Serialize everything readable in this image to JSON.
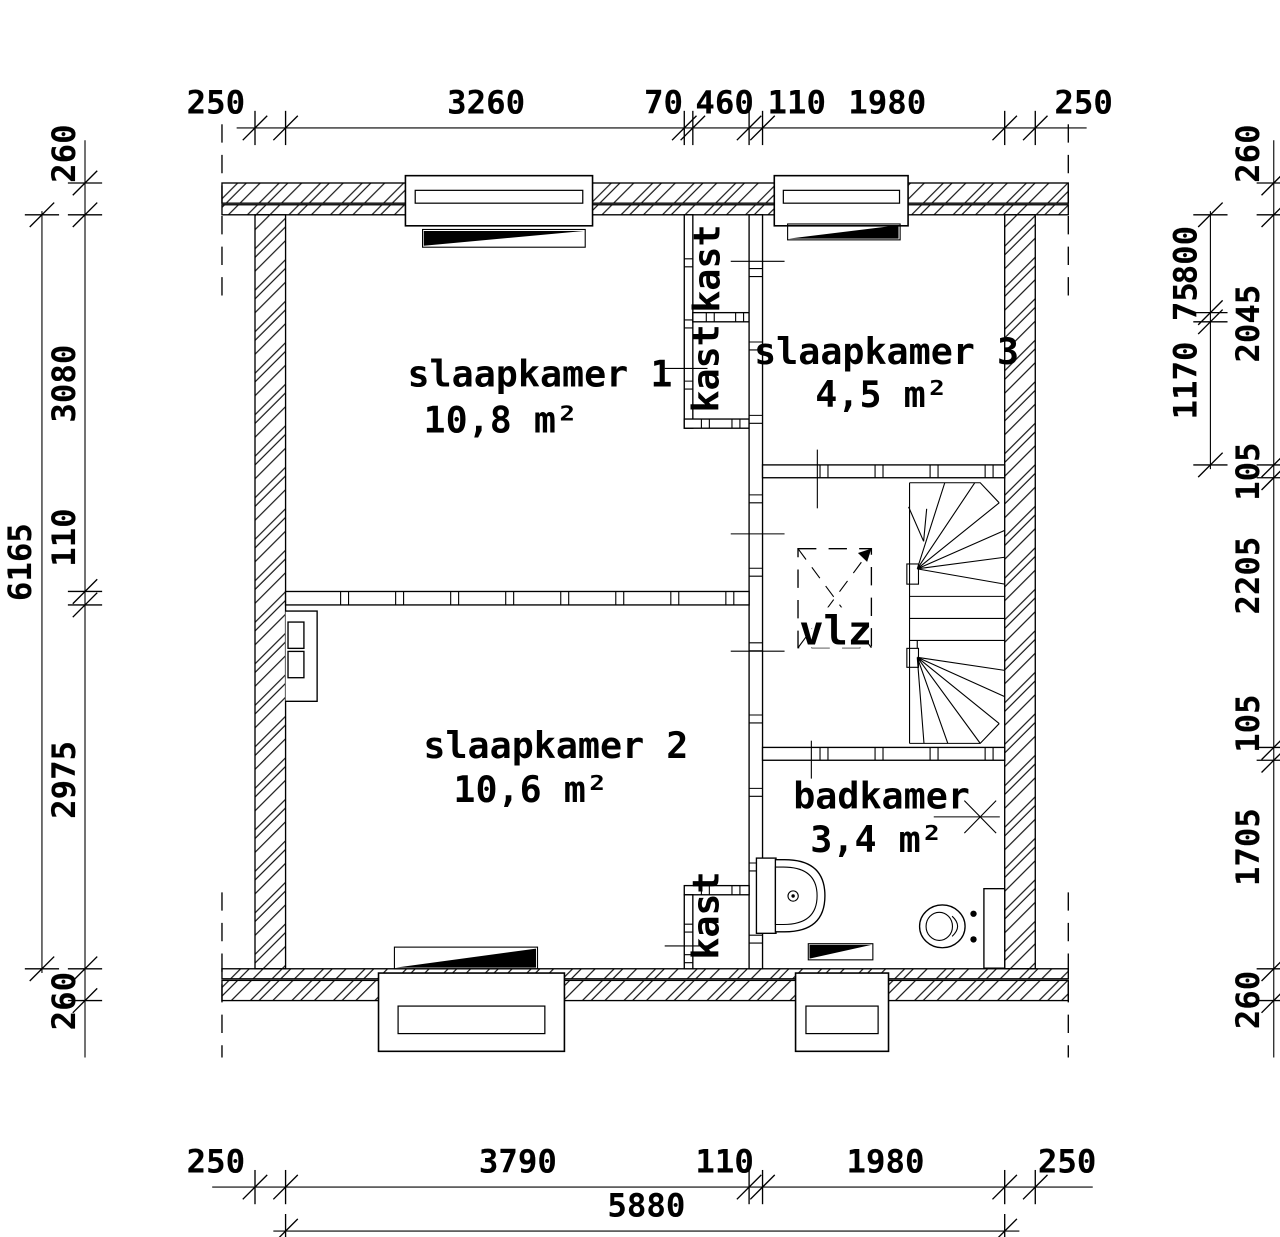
{
  "plan": {
    "type": "floor-plan",
    "colors": {
      "line": "#000000",
      "background": "#ffffff"
    },
    "rooms": {
      "slaapkamer1": {
        "name": "slaapkamer 1",
        "area": "10,8 m²"
      },
      "slaapkamer2": {
        "name": "slaapkamer 2",
        "area": "10,6 m²"
      },
      "slaapkamer3": {
        "name": "slaapkamer 3",
        "area": "4,5 m²"
      },
      "badkamer": {
        "name": "badkamer",
        "area": "3,4 m²"
      },
      "landing": {
        "hatch_label": "vlz"
      },
      "closet1": {
        "name": "kast"
      },
      "closet2": {
        "name": "kast"
      },
      "closet3": {
        "name": "kast"
      }
    },
    "dimensions": {
      "top": [
        "250",
        "3260",
        "70",
        "460",
        "110",
        "1980",
        "250"
      ],
      "left_outer_total": "6165",
      "left_inner": [
        "260",
        "3080",
        "110",
        "2975",
        "260"
      ],
      "right_inner": [
        "800",
        "75",
        "1170"
      ],
      "right_outer": [
        "260",
        "2045",
        "105",
        "2205",
        "105",
        "1705",
        "260"
      ],
      "bottom_inner": [
        "250",
        "3790",
        "110",
        "1980",
        "250"
      ],
      "bottom_total": "5880"
    }
  }
}
